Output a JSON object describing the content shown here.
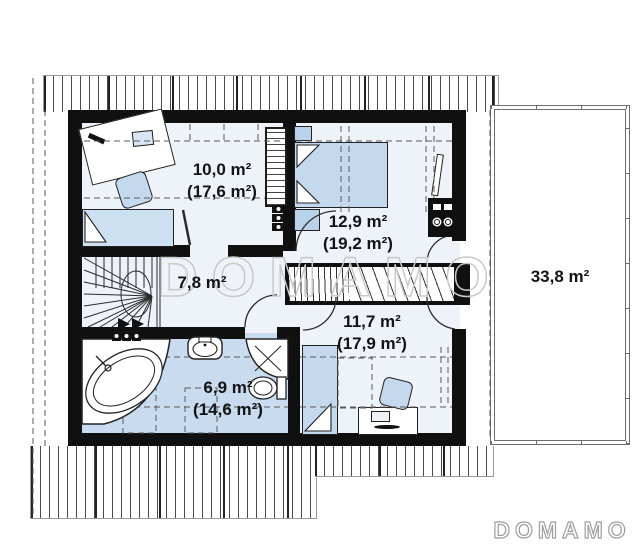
{
  "branding": {
    "watermark": "DOMAMO",
    "logo": "DOMAMO"
  },
  "rooms": {
    "room1": {
      "area": "10,0 m²",
      "total": "(17,6 m²)"
    },
    "bedroom": {
      "area": "12,9 m²",
      "total": "(19,2 m²)"
    },
    "hall": {
      "area": "7,8 m²"
    },
    "room2": {
      "area": "11,7 m²",
      "total": "(17,9 m²)"
    },
    "bathroom": {
      "area": "6,9 m²",
      "total": "(14,6 m²)"
    },
    "terrace": {
      "area": "33,8 m²"
    }
  },
  "colors": {
    "wall": "#101010",
    "floor": "#eef3f9",
    "bathroom_floor": "#c9dbee",
    "furniture_fill": "#c5d9ee",
    "outline": "#222222",
    "hatch_line": "#4a4a4a",
    "label_text": "#141414",
    "watermark_outline": "#c9c9c9",
    "logo_outline": "#9d9d9d"
  }
}
